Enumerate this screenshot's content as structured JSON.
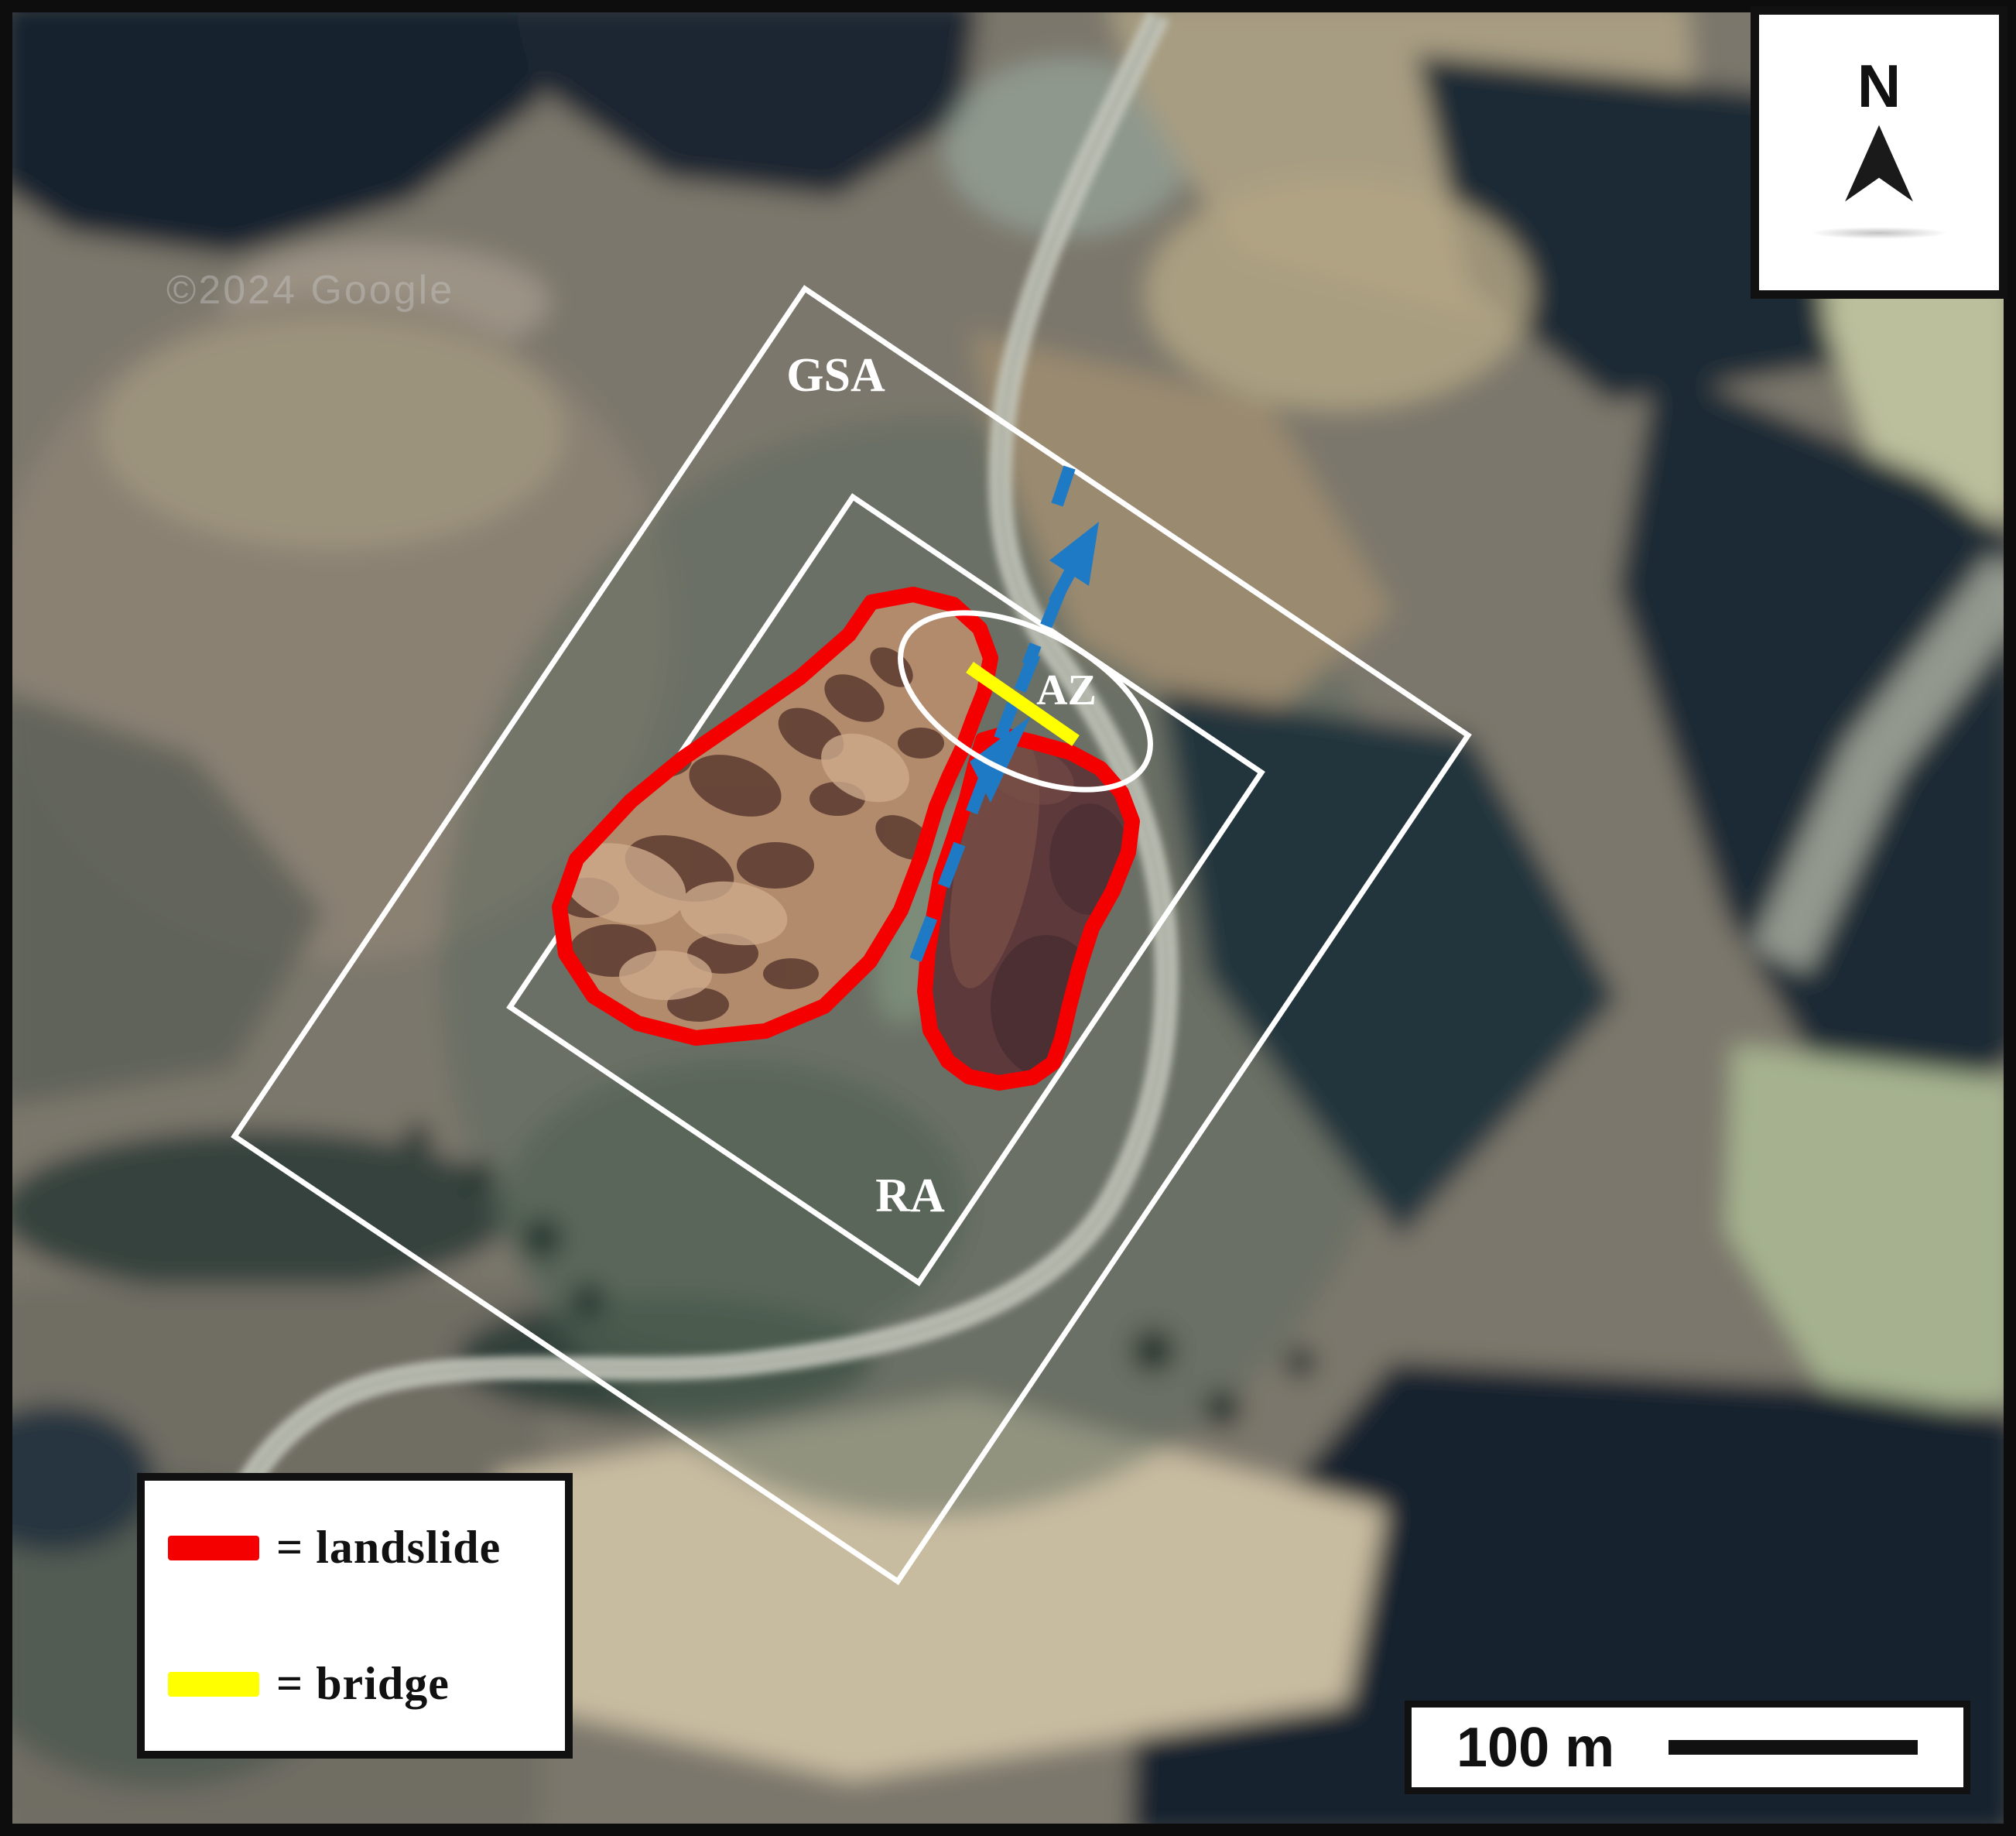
{
  "figure": {
    "watermark": "©2024 Google",
    "north_label": "N",
    "scale_label": "100 m",
    "area_labels": {
      "gsa": "GSA",
      "ra": "RA",
      "az": "AZ"
    },
    "legend": {
      "items": [
        {
          "label": "= landslide",
          "color": "#f40000"
        },
        {
          "label": "= bridge",
          "color": "#ffff00"
        }
      ]
    },
    "colors": {
      "landslide_outline": "#f40000",
      "bridge": "#ffff00",
      "flow_arrow": "#1f7ac6",
      "survey_outline": "#ffffff"
    }
  }
}
